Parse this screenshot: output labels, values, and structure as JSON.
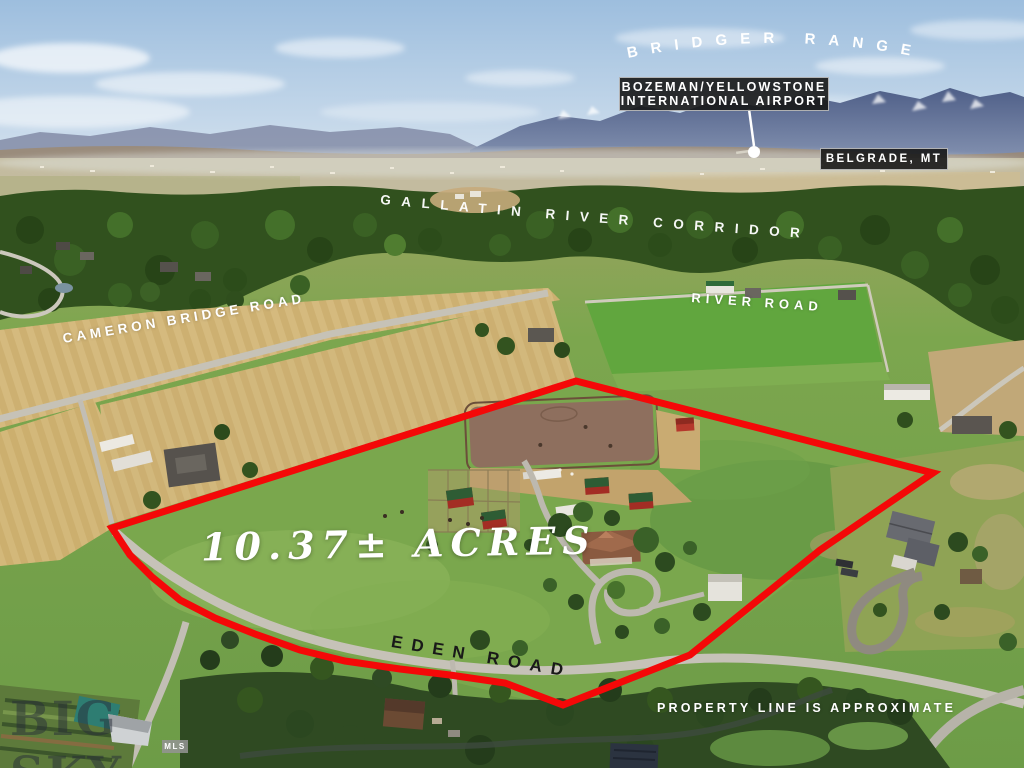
{
  "geo_labels": {
    "mountain_range": "BRIDGER RANGE",
    "river_corridor": "GALLATIN RIVER CORRIDOR",
    "river_road": "RIVER ROAD",
    "cameron_bridge_road": "CAMERON BRIDGE ROAD",
    "eden_road": "EDEN ROAD"
  },
  "callouts": {
    "airport_line1": "BOZEMAN/YELLOWSTONE",
    "airport_line2": "INTERNATIONAL AIRPORT",
    "city": "BELGRADE, MT"
  },
  "property": {
    "acreage": "10.37±  ACRES",
    "disclaimer": "PROPERTY LINE IS APPROXIMATE",
    "boundary_color": "#f40808"
  },
  "watermark": {
    "brand": "BIG SKY",
    "badge": "MLS"
  }
}
